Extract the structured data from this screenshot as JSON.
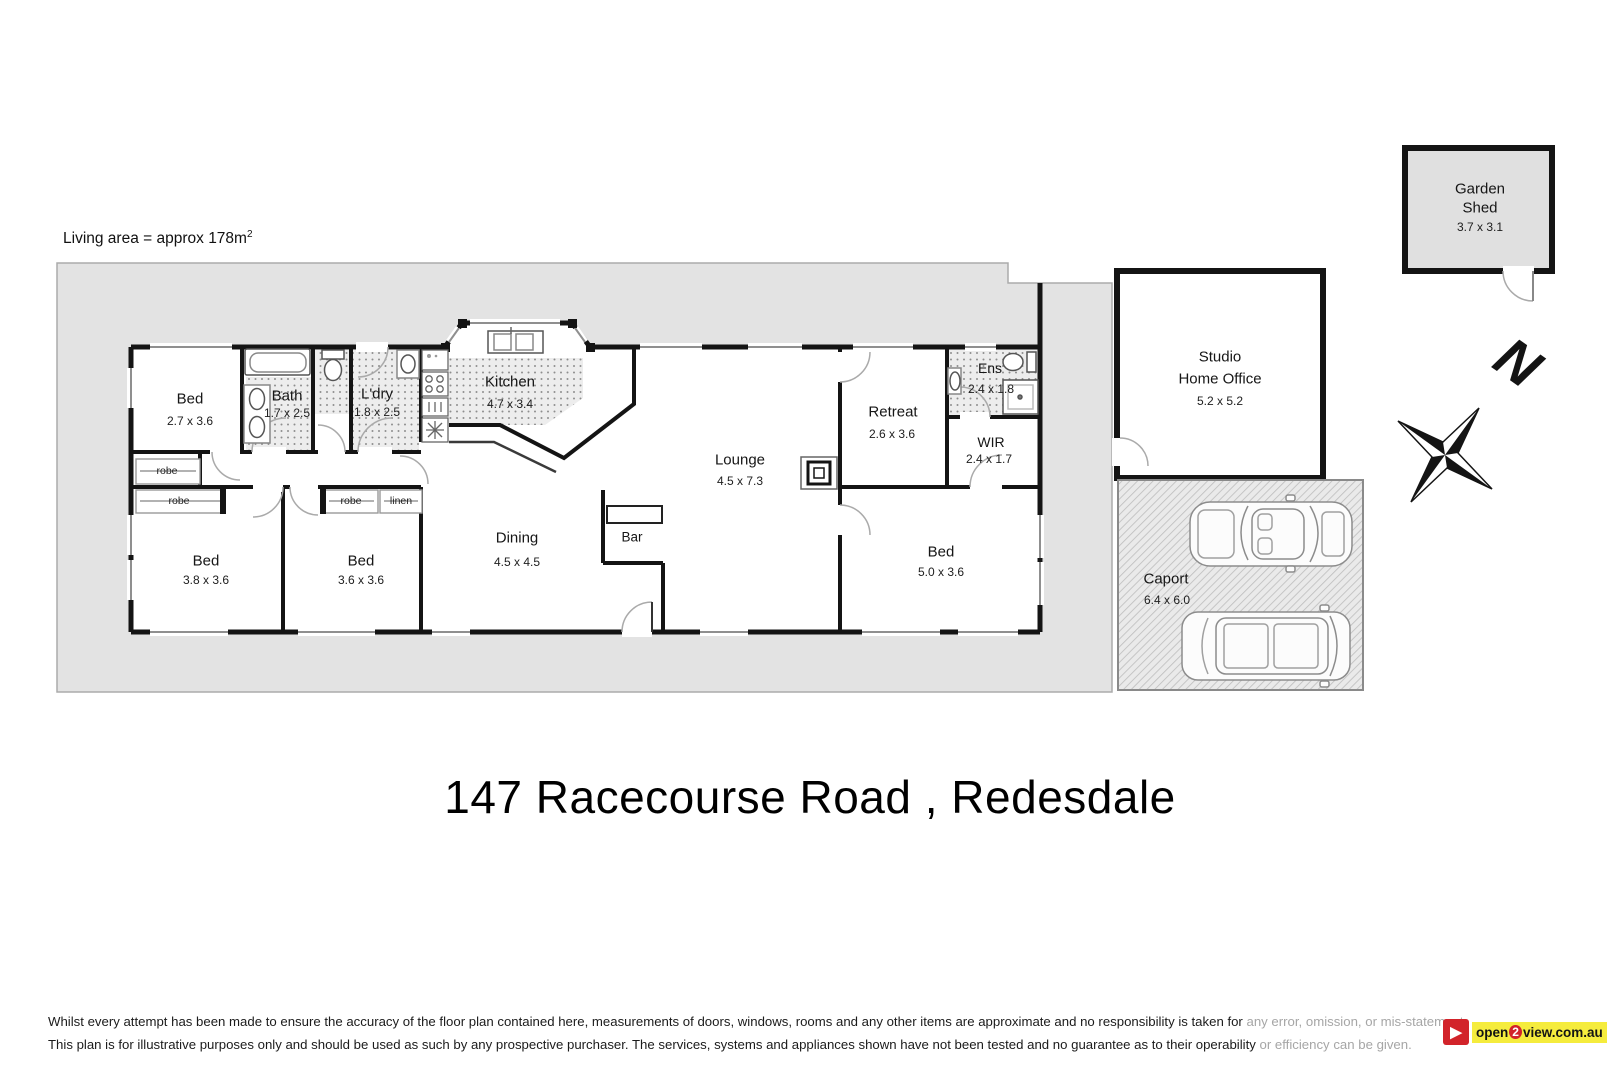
{
  "header": {
    "living_area_prefix": "Living area = approx 178m",
    "living_area_sup": "2"
  },
  "title": "147 Racecourse Road , Redesdale",
  "compass": {
    "north_label": "N"
  },
  "rooms": {
    "bed1": {
      "name": "Bed",
      "dims": "2.7 x 3.6"
    },
    "bed2": {
      "name": "Bed",
      "dims": "3.8 x 3.6"
    },
    "bed3": {
      "name": "Bed",
      "dims": "3.6 x 3.6"
    },
    "bed4": {
      "name": "Bed",
      "dims": "5.0 x 3.6"
    },
    "bath": {
      "name": "Bath",
      "dims": "1.7 x 2.5"
    },
    "laundry": {
      "name": "L'dry",
      "dims": "1.8 x 2.5"
    },
    "kitchen": {
      "name": "Kitchen",
      "dims": "4.7 x 3.4"
    },
    "dining": {
      "name": "Dining",
      "dims": "4.5 x 4.5"
    },
    "lounge": {
      "name": "Lounge",
      "dims": "4.5 x 7.3"
    },
    "bar": {
      "name": "Bar"
    },
    "retreat": {
      "name": "Retreat",
      "dims": "2.6 x 3.6"
    },
    "ens": {
      "name": "Ens",
      "dims": "2.4 x 1.8"
    },
    "wir": {
      "name": "WIR",
      "dims": "2.4 x 1.7"
    },
    "studio": {
      "name_line1": "Studio",
      "name_line2": "Home Office",
      "dims": "5.2 x 5.2"
    },
    "caport": {
      "name": "Caport",
      "dims": "6.4 x 6.0"
    },
    "shed": {
      "name_line1": "Garden",
      "name_line2": "Shed",
      "dims": "3.7 x 3.1"
    }
  },
  "closets": {
    "robe1": "robe",
    "robe2": "robe",
    "robe3": "robe",
    "linen": "linen"
  },
  "footer": {
    "disclaimer_line1_main": "Whilst every attempt has been made to ensure the accuracy of the floor plan contained here, measurements of doors, windows, rooms and any other items are approximate and no responsibility is taken for ",
    "disclaimer_line1_faded": "any error, omission, or mis-statement.",
    "disclaimer_line2_main": "This plan is for illustrative purposes only and should be used as such by any prospective purchaser. The services, systems and appliances shown have not been tested and no guarantee as to their operability ",
    "disclaimer_line2_faded": "or efficiency can be given.",
    "logo": {
      "icon_glyph": "▶",
      "part1": "open",
      "part2": "2",
      "part3": "view.com.au"
    }
  },
  "colors": {
    "pad": "#e3e3e3",
    "wall": "#141414",
    "logo_red": "#d2232a",
    "logo_yellow": "#f5ec3d"
  }
}
